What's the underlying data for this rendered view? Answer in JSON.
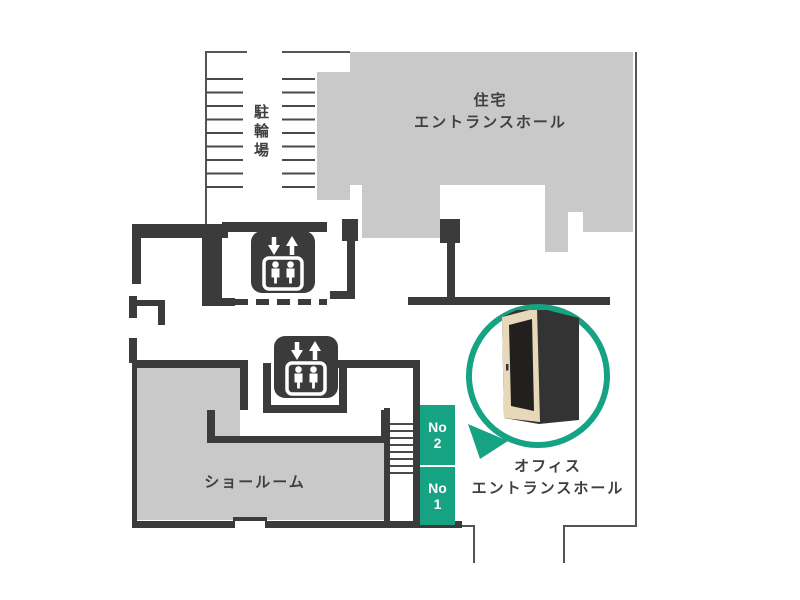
{
  "floorplan": {
    "areas": {
      "bicycle_parking": {
        "label": "駐輪場"
      },
      "residential_hall": {
        "label_line1": "住宅",
        "label_line2": "エントランスホール"
      },
      "showroom": {
        "label": "ショールーム"
      },
      "office_hall": {
        "label_line1": "オフィス",
        "label_line2": "エントランスホール"
      }
    },
    "units": [
      {
        "line1": "No",
        "line2": "2"
      },
      {
        "line1": "No",
        "line2": "1"
      }
    ],
    "icons": {
      "elevator": "elevator-icon",
      "booth": "office-booth-illustration"
    },
    "colors": {
      "accent_teal": "#16a383",
      "wall_dark": "#3b3b3b",
      "area_gray": "#c9c9c9",
      "booth_beige": "#e7d8b9"
    }
  }
}
